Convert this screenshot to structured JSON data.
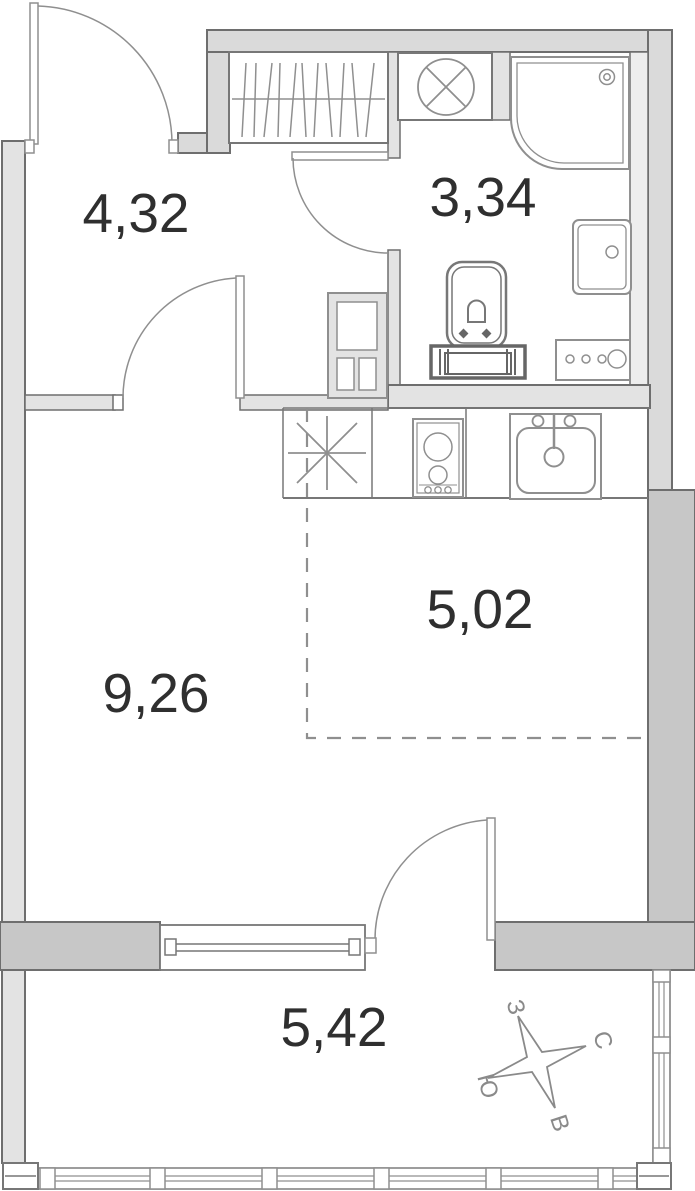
{
  "plan": {
    "title": "studio-apartment-floor-plan",
    "rooms": {
      "hallway": {
        "area": "4,32"
      },
      "bathroom": {
        "area": "3,34"
      },
      "living_room": {
        "area": "9,26"
      },
      "kitchen_zone": {
        "area": "5,02"
      },
      "balcony": {
        "area": "5,42"
      }
    },
    "compass": {
      "north": "С",
      "south": "Ю",
      "west": "З",
      "east": "В"
    },
    "colors": {
      "wall_light": "#e3e3e3",
      "wall_medium": "#dadada",
      "wall_dark": "#c7c7c7",
      "outline": "#6e6e6e",
      "fixture_stroke": "#8f8f8f",
      "label_text": "#2f2f2f",
      "dashed_zone": "#8f8f8f"
    }
  }
}
